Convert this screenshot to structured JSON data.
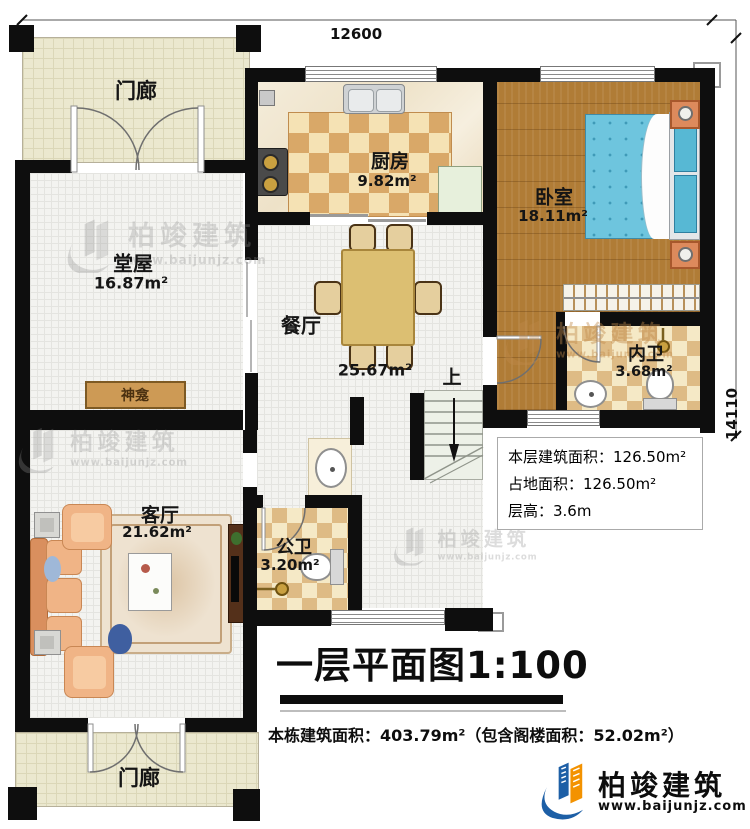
{
  "dimensions": {
    "width_mm": "12600",
    "height_mm": "14110"
  },
  "rooms": {
    "porch_top": {
      "label": "门廊"
    },
    "kitchen": {
      "label": "厨房",
      "area": "9.82m²"
    },
    "bedroom": {
      "label": "卧室",
      "area": "18.11m²"
    },
    "hall": {
      "label": "堂屋",
      "area": "16.87m²"
    },
    "dining": {
      "label": "餐厅",
      "area": "25.67m²"
    },
    "ensuite": {
      "label": "内卫",
      "area": "3.68m²"
    },
    "living": {
      "label": "客厅",
      "area": "21.62m²"
    },
    "public_bath": {
      "label": "公卫",
      "area": "3.20m²"
    },
    "porch_bottom": {
      "label": "门廊"
    }
  },
  "features": {
    "shrine": "神龛",
    "stairs_up": "上"
  },
  "info_box": {
    "floor_area": "本层建筑面积：126.50m²",
    "footprint_area": "占地面积：126.50m²",
    "floor_height": "层高：3.6m"
  },
  "title": "一层平面图1:100",
  "subtitle": "本栋建筑面积：403.79m²（包含阁楼面积：52.02m²）",
  "brand": {
    "name": "柏竣建筑",
    "website": "www.baijunjz.com"
  },
  "colors": {
    "wall": "#0e0e0e",
    "brand_blue": "#1d5fa6",
    "brand_orange": "#f39200"
  }
}
